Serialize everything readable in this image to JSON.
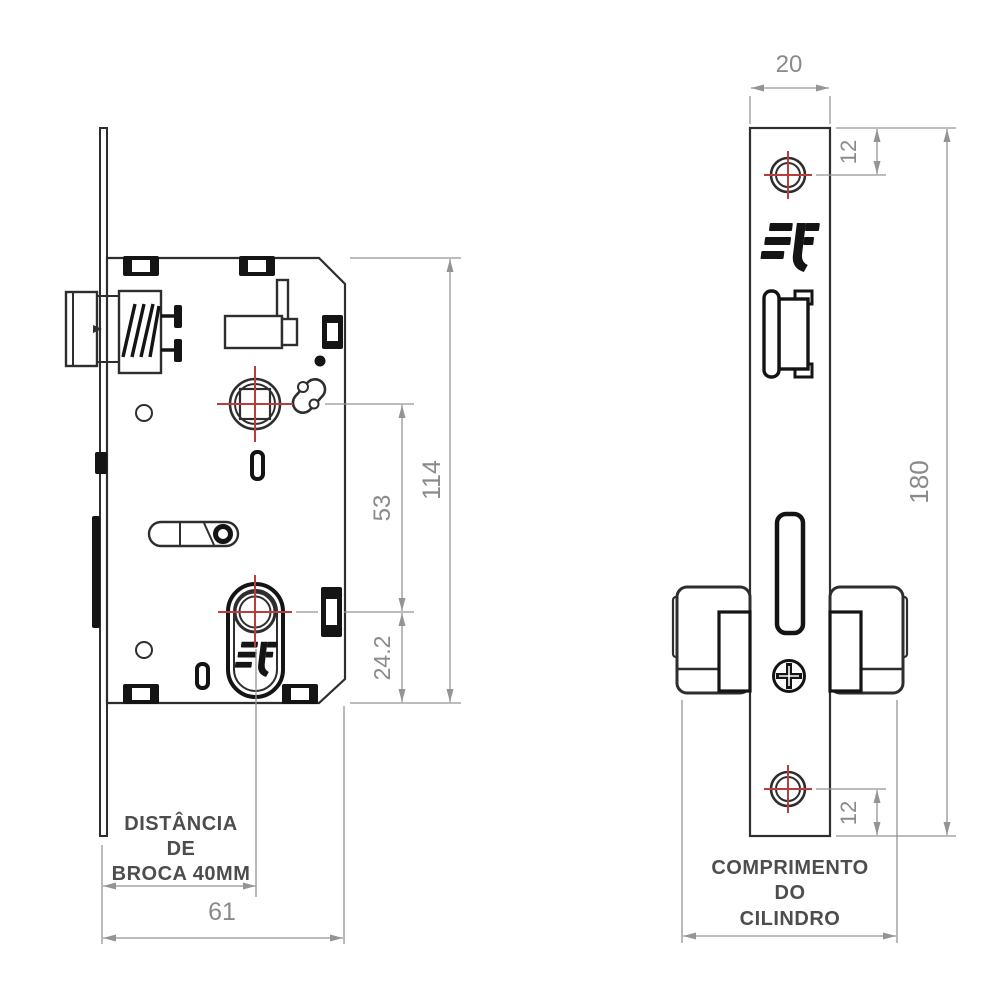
{
  "drawing": {
    "type": "mortise-lock technical drawing, two orthographic views"
  },
  "colors": {
    "outline": "#2e2e2e",
    "fitting_black": "#141414",
    "dim_line": "#949494",
    "dim_text": "#8a8a8a",
    "label_text": "#4d4d4d",
    "crosshair_red": "#b83d3d",
    "background": "#ffffff"
  },
  "icons": {
    "brand_logo": "3f-brand-monogram",
    "phillips_screw": "phillips-screw-head",
    "screw_hole_marker": "red-crosshair-center-mark"
  },
  "left_view": {
    "dim_114": "114",
    "dim_53": "53",
    "dim_24_2": "24.2",
    "dim_61": "61",
    "drill_note_line1": "DISTÂNCIA",
    "drill_note_line2": "DE",
    "drill_note_line3": "BROCA 40MM"
  },
  "right_view": {
    "dim_20": "20",
    "dim_12_top": "12",
    "dim_180": "180",
    "dim_12_bottom": "12",
    "cylinder_note_line1": "COMPRIMENTO",
    "cylinder_note_line2": "DO",
    "cylinder_note_line3": "CILINDRO"
  }
}
